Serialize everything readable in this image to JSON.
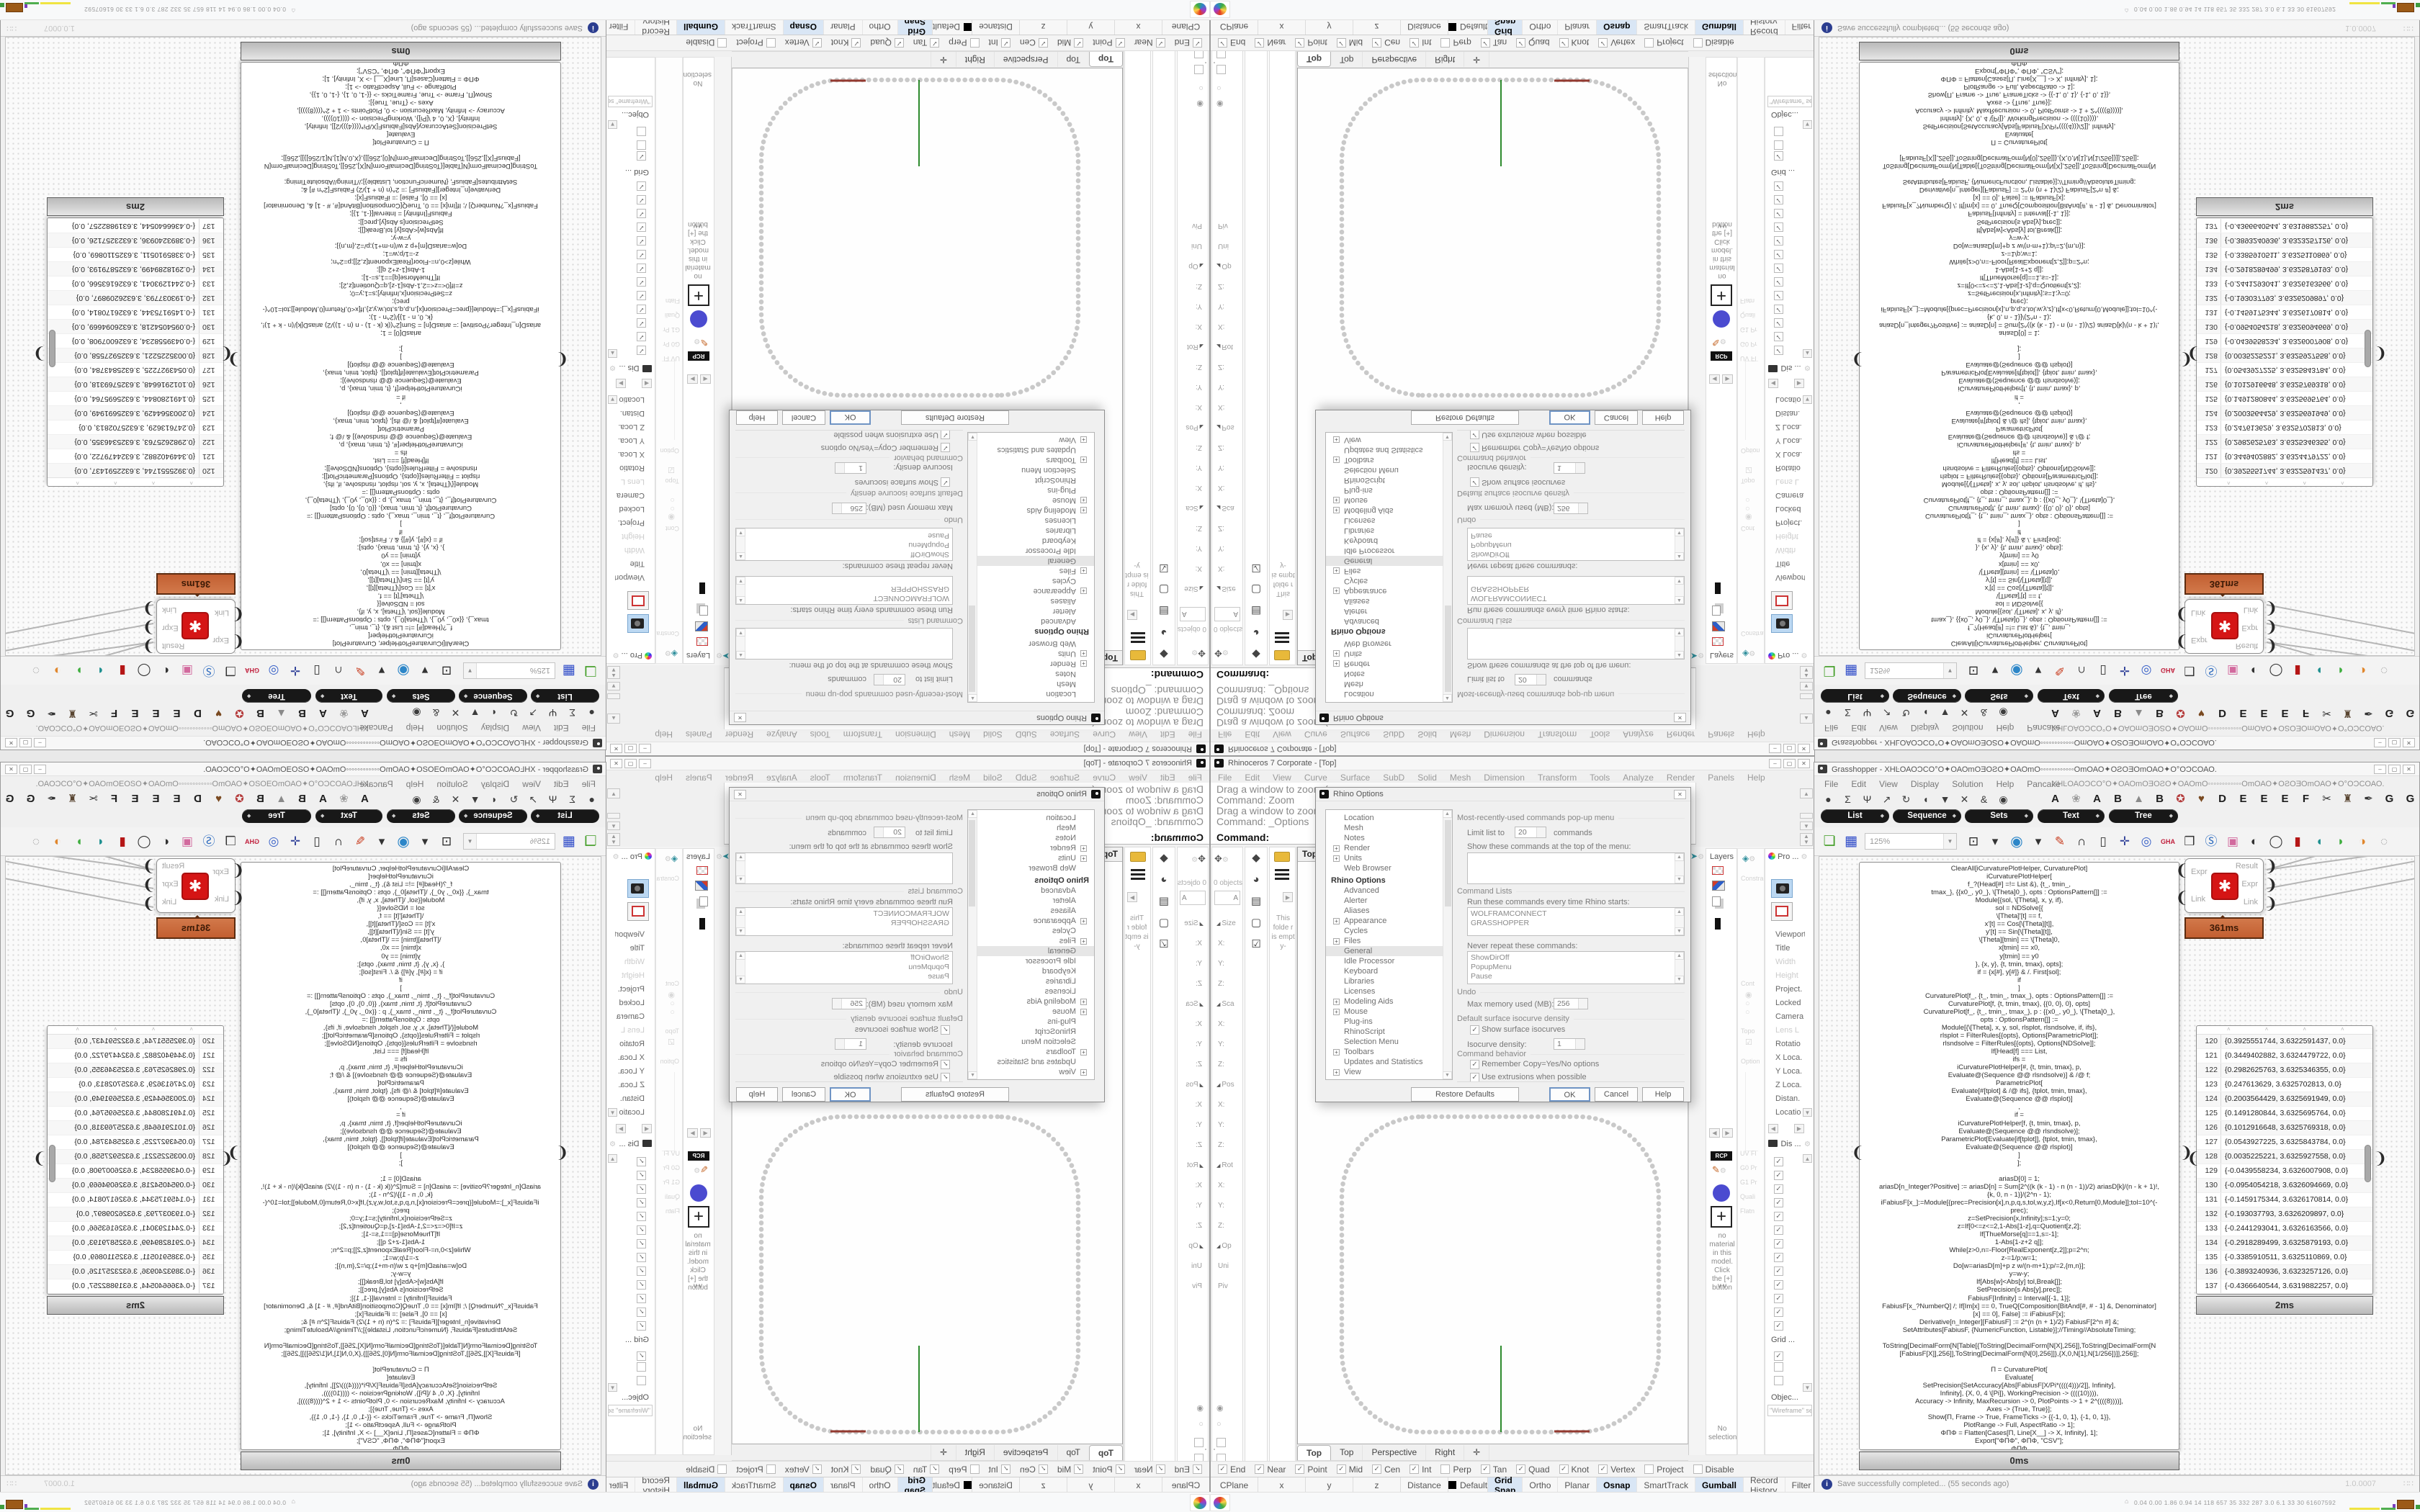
{
  "rhino": {
    "title": "Rhinoceros 7 Corporate - [Top]",
    "menus": [
      "File",
      "Edit",
      "View",
      "Curve",
      "Surface",
      "SubD",
      "Solid",
      "Mesh",
      "Dimension",
      "Transform",
      "Tools",
      "Analyze",
      "Render",
      "Panels",
      "Help"
    ],
    "window_buttons": [
      {
        "n": "minimize-button",
        "g": "–"
      },
      {
        "n": "maximize-button",
        "g": "▢"
      },
      {
        "n": "close-button",
        "g": "✕"
      }
    ],
    "command_history": [
      "Drag a window to zoom (",
      "Command: Zoom",
      "Drag a window to zoom (",
      "Command: _Options"
    ],
    "command_prompt": "Command:",
    "boxedit": {
      "objects_label": "0 objects",
      "field_value": "A",
      "rows": [
        {
          "t": "◢",
          "l": "Size"
        },
        {
          "t": "",
          "l": "X:"
        },
        {
          "t": "",
          "l": "Y:"
        },
        {
          "t": "",
          "l": "Z:"
        },
        {
          "t": "◢",
          "l": "Sca"
        },
        {
          "t": "",
          "l": "X:"
        },
        {
          "t": "",
          "l": "Y:"
        },
        {
          "t": "",
          "l": "Z:"
        },
        {
          "t": "◢",
          "l": "Pos"
        },
        {
          "t": "",
          "l": "X:"
        },
        {
          "t": "",
          "l": "Y:"
        },
        {
          "t": "",
          "l": "Z:"
        },
        {
          "t": "◢",
          "l": "Rot"
        },
        {
          "t": "",
          "l": "X:"
        },
        {
          "t": "",
          "l": "Y:"
        },
        {
          "t": "",
          "l": "Z:"
        },
        {
          "t": "◢",
          "l": "Op"
        },
        {
          "t": "",
          "l": "Uni"
        },
        {
          "t": "",
          "l": "Piv"
        }
      ]
    },
    "left_tabs": [
      {
        "n": "cap-icon",
        "g": "◆",
        "c": "#1a1a1a"
      },
      {
        "n": "sphere-icon",
        "g": "◕",
        "c": "#2f9c8e"
      },
      {
        "n": "panel2-icon",
        "g": "▤",
        "c": "#5a3aa8"
      },
      {
        "n": "swatch-icon",
        "g": "▢",
        "c": "#bbb"
      },
      {
        "n": "checkpen-icon",
        "g": "☑",
        "c": "#8a8a8a"
      }
    ],
    "folder_note": "This folde r is empt y-",
    "viewport": {
      "label": "Top",
      "tabs": [
        {
          "l": "Top",
          "on": "1"
        },
        {
          "l": "Top",
          "on": ""
        },
        {
          "l": "Perspective",
          "on": ""
        },
        {
          "l": "Right",
          "on": ""
        },
        {
          "l": "✛",
          "on": ""
        }
      ]
    },
    "osnap": [
      {
        "l": "End",
        "c": "✓"
      },
      {
        "l": "Near",
        "c": "✓"
      },
      {
        "l": "Point",
        "c": "✓"
      },
      {
        "l": "Mid",
        "c": "✓"
      },
      {
        "l": "Cen",
        "c": "✓"
      },
      {
        "l": "Int",
        "c": "✓"
      },
      {
        "l": "Perp",
        "c": ""
      },
      {
        "l": "Tan",
        "c": "✓"
      },
      {
        "l": "Quad",
        "c": "✓"
      },
      {
        "l": "Knot",
        "c": "✓"
      },
      {
        "l": "Vertex",
        "c": "✓"
      },
      {
        "l": "Project",
        "c": ""
      },
      {
        "l": "Disable",
        "c": ""
      }
    ],
    "status": {
      "cells": [
        "CPlane",
        "x",
        "y",
        "z",
        "Distance"
      ],
      "default_label": "Default",
      "toggles": [
        {
          "l": "Grid Snap",
          "on": "1"
        },
        {
          "l": "Ortho",
          "on": ""
        },
        {
          "l": "Planar",
          "on": ""
        },
        {
          "l": "Osnap",
          "on": "1"
        },
        {
          "l": "SmartTrack",
          "on": ""
        },
        {
          "l": "Gumball",
          "on": "1"
        },
        {
          "l": "Record History",
          "on": ""
        },
        {
          "l": "Filter",
          "on": ""
        }
      ]
    },
    "layers_title": "Layers",
    "materials": {
      "rcp": "RCP",
      "empty_text": "no material in this model. Click the [+] button",
      "chevrons": "∨∨",
      "no_selection": "No selection"
    },
    "constraints": {
      "title": "Constra",
      "faint1": "Cont",
      "faint2": "Topo",
      "faint3": "Option",
      "labels": [
        "UV Fl",
        "G0 Pr",
        "G1 Pr",
        "Quali",
        "Flatn"
      ]
    },
    "properties": {
      "title": "Pro ...",
      "rows": [
        {
          "l": "Viewport",
          "d": "",
          "s": ""
        },
        {
          "l": "Title",
          "d": "",
          "s": ""
        },
        {
          "l": "Width",
          "d": "1",
          "s": ""
        },
        {
          "l": "Height",
          "d": "1",
          "s": ""
        },
        {
          "l": "Project.",
          "d": "",
          "s": ""
        },
        {
          "l": "Locked",
          "d": "",
          "s": ""
        },
        {
          "l": "Camera",
          "d": "",
          "s": "1"
        },
        {
          "l": "Lens L",
          "d": "1",
          "s": ""
        },
        {
          "l": "Rotatio",
          "d": "",
          "s": ""
        },
        {
          "l": "X Loca.",
          "d": "",
          "s": ""
        },
        {
          "l": "Y Loca.",
          "d": "",
          "s": ""
        },
        {
          "l": "Z Loca.",
          "d": "",
          "s": ""
        },
        {
          "l": "Distan.",
          "d": "",
          "s": ""
        },
        {
          "l": "Locatio",
          "d": "",
          "s": ""
        }
      ],
      "display_title": "Dis ...",
      "display_checks": [
        "✓",
        "✓",
        "✓",
        "✓",
        "✓",
        "✓",
        "✓",
        "✓",
        "✓",
        "✓",
        "✓",
        "✓",
        "✓"
      ],
      "grid_label": "Grid ...",
      "grid_checks": [
        "✓",
        "",
        ""
      ],
      "object_label": "Objec...",
      "object_field": "\"Wireframe\" set"
    },
    "options_dialog": {
      "title": "Rhino Options",
      "tree": [
        {
          "p": "",
          "k": "",
          "l": "Location"
        },
        {
          "p": "",
          "k": "",
          "l": "Mesh"
        },
        {
          "p": "",
          "k": "",
          "l": "Notes"
        },
        {
          "p": "+",
          "k": "",
          "l": "Render"
        },
        {
          "p": "+",
          "k": "",
          "l": "Units"
        },
        {
          "p": "",
          "k": "",
          "l": "Web Browser"
        },
        {
          "p": "",
          "k": "h",
          "l": "Rhino Options"
        },
        {
          "p": "",
          "k": "",
          "l": "Advanced"
        },
        {
          "p": "",
          "k": "",
          "l": "Alerter"
        },
        {
          "p": "",
          "k": "",
          "l": "Aliases"
        },
        {
          "p": "+",
          "k": "",
          "l": "Appearance"
        },
        {
          "p": "",
          "k": "",
          "l": "Cycles"
        },
        {
          "p": "+",
          "k": "",
          "l": "Files"
        },
        {
          "p": "",
          "k": "sel",
          "l": "General"
        },
        {
          "p": "",
          "k": "",
          "l": "Idle Processor"
        },
        {
          "p": "",
          "k": "",
          "l": "Keyboard"
        },
        {
          "p": "",
          "k": "",
          "l": "Libraries"
        },
        {
          "p": "",
          "k": "",
          "l": "Licenses"
        },
        {
          "p": "+",
          "k": "",
          "l": "Modeling Aids"
        },
        {
          "p": "+",
          "k": "",
          "l": "Mouse"
        },
        {
          "p": "",
          "k": "",
          "l": "Plug-ins"
        },
        {
          "p": "",
          "k": "",
          "l": "RhinoScript"
        },
        {
          "p": "",
          "k": "",
          "l": "Selection Menu"
        },
        {
          "p": "+",
          "k": "",
          "l": "Toolbars"
        },
        {
          "p": "",
          "k": "",
          "l": "Updates and Statistics"
        },
        {
          "p": "+",
          "k": "",
          "l": "View"
        }
      ],
      "group1_label": "Most-recently-used commands pop-up menu",
      "limit_prefix": "Limit list to",
      "limit_value": "20",
      "limit_suffix": "commands",
      "show_label": "Show these commands at the top of the menu:",
      "group2_label": "Command Lists",
      "run_label": "Run these commands every time Rhino starts:",
      "run_items": [
        "WOLFRAMCONNECT",
        "GRASSHOPPER"
      ],
      "never_label": "Never repeat these commands:",
      "never_items": [
        "ShowDirOff",
        "PopupMenu",
        "Pause"
      ],
      "undo_label": "Undo",
      "memory_label": "Max memory used (MB):",
      "memory_value": "256",
      "iso_label": "Default surface isocurve density",
      "iso_show": "Show surface isocurves",
      "iso_density_label": "Isocurve density:",
      "iso_density_value": "1",
      "behavior_label": "Command behavior",
      "behavior_cb1": "Remember Copy=Yes/No options",
      "behavior_cb2": "Use extrusions when possible",
      "buttons": [
        {
          "n": "restore-defaults-button",
          "l": "Restore Defaults"
        },
        {
          "n": "ok-button",
          "l": "OK"
        },
        {
          "n": "cancel-button",
          "l": "Cancel"
        },
        {
          "n": "help-button",
          "l": "Help"
        }
      ]
    }
  },
  "grasshopper": {
    "title": "Grasshopper - XHĿΟΑΟƆCΟ°Ο✦ΟΑΟmΟƎΟƧΟ✦ΟΑΟmΟ◦◦◦◦◦◦◦◦◦◦◦◦ΟmΟΑΟ✦ΟƧΟƎΟmΟΑΟ✦Ο°ΟƆCΟΑΟ.",
    "menus": [
      "File",
      "Edit",
      "View",
      "Display",
      "Solution",
      "Help",
      "Pancake"
    ],
    "doc_garble": "XHĿΟΑΟƆCΟ°Ο✦ΟΑΟmΟƎΟƧΟ✦ΟΑΟmΟ◦◦◦◦◦◦◦◦◦◦◦◦ΟmΟΑΟ✦ΟƧΟƎΟmΟΑΟ✦Ο°ΟƆCΟΑΟ.",
    "window_buttons": [
      {
        "n": "minimize-button",
        "g": "–"
      },
      {
        "n": "maximize-button",
        "g": "▢"
      },
      {
        "n": "close-button",
        "g": "✕"
      }
    ],
    "main_tabs": [
      {
        "n": "tab-params",
        "g": "●",
        "sel": ""
      },
      {
        "n": "tab-maths",
        "g": "Σ",
        "sel": ""
      },
      {
        "n": "tab-sets",
        "g": "Ψ",
        "sel": "1"
      },
      {
        "n": "tab-vector",
        "g": "↗",
        "sel": ""
      },
      {
        "n": "tab-curve",
        "g": "↻",
        "sel": ""
      },
      {
        "n": "tab-surface",
        "g": "◖",
        "sel": ""
      },
      {
        "n": "tab-mesh",
        "g": "▼",
        "sel": ""
      },
      {
        "n": "tab-intersect",
        "g": "✕",
        "sel": ""
      },
      {
        "n": "tab-transform",
        "g": "&",
        "sel": ""
      },
      {
        "n": "tab-display",
        "g": "◉",
        "sel": ""
      }
    ],
    "letter_tabs": [
      "A",
      "❀",
      "A",
      "B",
      "▲",
      "B",
      "✪",
      "♥",
      "D",
      "E",
      "E",
      "E",
      "F",
      "✂",
      "♜",
      "✒",
      "G",
      "G"
    ],
    "pills": [
      "List",
      "Sequence",
      "Sets",
      "Text",
      "Tree"
    ],
    "zoom_level": "125%",
    "toolbar_group1": [
      {
        "n": "open-file-icon",
        "g": "❏"
      },
      {
        "n": "save-file-icon",
        "g": "▦"
      }
    ],
    "toolbar_group2": [
      {
        "n": "zoom-extents-icon",
        "g": "⊡"
      },
      {
        "n": "zoom-caret-icon",
        "g": "▾"
      },
      {
        "n": "preview-eye-icon",
        "g": "◉"
      },
      {
        "n": "preview-caret-icon",
        "g": "▾"
      },
      {
        "n": "sketch-brush-icon",
        "g": "✎"
      },
      {
        "n": "headphones-icon",
        "g": "∩"
      },
      {
        "n": "speaker-icon",
        "g": "▯"
      },
      {
        "n": "axes-icon",
        "g": "✛"
      },
      {
        "n": "connect-icon",
        "g": "◎"
      },
      {
        "n": "gha-badge-icon",
        "g": "GHA"
      },
      {
        "n": "window-chart-icon",
        "g": "❒"
      },
      {
        "n": "script-search-icon",
        "g": "Ⓢ"
      },
      {
        "n": "package-icon",
        "g": "▣"
      },
      {
        "n": "sphere-bw-icon",
        "g": "◐"
      },
      {
        "n": "cylinder-icon",
        "g": "◯"
      },
      {
        "n": "red-cylinder-icon",
        "g": "▮"
      },
      {
        "n": "teal-blob-icon",
        "g": "◖"
      },
      {
        "n": "green-blob-icon",
        "g": "◗"
      },
      {
        "n": "orange-sphere-icon",
        "g": "◑"
      },
      {
        "n": "selection-circle-icon",
        "g": "◌"
      }
    ],
    "code_time": "0ms",
    "code_lines": [
      "ClearAll[iCurvaturePlotHelper, CurvaturePlot]",
      "iCurvaturePlotHelper[",
      "f_?(Head[#] =!= List &), {t_, tmin_,",
      "tmax_}, {{x0_, y0_}, \\[Theta]0_}, opts : OptionsPattern[]] :=",
      "Module[{sol, \\[Theta], x, y, if},",
      "sol = NDSolve[{",
      "\\[Theta]'[t] == f,",
      "x'[t] == Cos[\\[Theta][t]],",
      "y'[t] == Sin[\\[Theta][t]],",
      "\\[Theta][tmin] == \\[Theta]0,",
      "x[tmin] == x0,",
      "y[tmin] == y0",
      "}, {x, y}, {t, tmin, tmax}, opts];",
      "if = {x[#], y[#]} & /. First[sol];",
      "if",
      "]",
      "CurvaturePlot[f_, {t_, tmin_, tmax_}, opts : OptionsPattern[]] :=",
      "CurvaturePlot[f, {t, tmin, tmax}, {{0, 0}, 0}, opts]",
      "CurvaturePlot[f_, {t_, tmin_, tmax_}, p : {{x0_, y0_}, \\[Theta]0_},",
      "opts : OptionsPattern[]] :=",
      "Module[{\\[Theta], x, y, sol, rlsplot, rlsndsolve, if, ifs},",
      "rlsplot = FilterRules[{opts}, Options[ParametricPlot]];",
      "rlsndsolve = FilterRules[{opts}, Options[NDSolve]];",
      "If[Head[f] === List,",
      "ifs =",
      "iCurvaturePlotHelper[#, {t, tmin, tmax}, p,",
      "Evaluate@(Sequence @@ rlsndsolve)] & /@ f;",
      "ParametricPlot[",
      "Evaluate[#[tplot] & /@ ifs], {tplot, tmin, tmax},",
      "Evaluate@(Sequence @@ rlsplot)]",
      ",",
      "if =",
      "iCurvaturePlotHelper[f, {t, tmin, tmax}, p,",
      "Evaluate@(Sequence @@ rlsndsolve)];",
      "ParametricPlot[Evaluate[if[tplot]], {tplot, tmin, tmax},",
      "Evaluate@(Sequence @@ rlsplot)]",
      "]",
      "];",
      "",
      "ariasD[0] = 1;",
      "ariasD[n_Integer?Positive] := ariasD[n] = Sum[2^((k (k - 1) - n (n - 1))/2) ariasD[k]/(n - k + 1)!,",
      "{k, 0, n - 1}]/(2^n - 1);",
      "iFabiusF[x_]:=Module[{prec=Precision[x],n,p,q,s,tol,w,y,z},If[x<0,Return[0,Module]];tol=10^(-",
      "prec);",
      "z=SetPrecision[x,Infinity];s=1;y=0;",
      "z=If[0<=z<=2,1-Abs[1-z],q=Quotient[z,2];",
      "If[ThueMorse[q]==1,s=-1];",
      "1-Abs[1-z+2 q]];",
      "While[z>0,n=-Floor[RealExponent[z,2]];p=2^n;",
      "z-=1/p;w=1;",
      "Do[w=ariasD[m]+p z w/(n-m+1);p/=2,{m,n}];",
      "y=w-y;",
      "If[Abs[w]<Abs[y] tol,Break[]];",
      "SetPrecision[s Abs[y],prec]];",
      "FabiusF[Infinity] = Interval[{-1, 1}];",
      "FabiusF[x_?NumberQ] /; If[Im[x] == 0, TrueQ[Composition[BitAnd[#, # - 1] &, Denominator]",
      "[x] == 0], False] := iFabiusF[x];",
      "Derivative[n_Integer][FabiusF] := 2^(n (n + 1)/2) FabiusF[2^n #] &;",
      "SetAttributes[FabiusF, {NumericFunction, Listable}];//Timing//AbsoluteTiming;",
      "",
      "ToString[DecimalForm[N[Table[{ToString[DecimalForm[N[X],256]],ToString[DecimalForm[N",
      "[FabiusF[X]],256]],ToString[DecimalForm[N[0],256]]},{X,0,N[1],N[1/256]}]],256]];",
      "",
      "Π = CurvaturePlot[",
      "Evaluate[",
      "SetPrecision[SetAccuracy[Abs[FabiusF[X/Pi*((((4)))/2]], Infinity],",
      "Infinity], {X, 0, 4 \\[Pi]}, WorkingPrecision -> ((((10)))),",
      "Accuracy -> Infinity, MaxRecursion -> 0, PlotPoints -> 1 + 2^((((8))))],",
      "Axes -> {True, True}];",
      "Show[Π, Frame -> True, FrameTicks -> {{-1, 0, 1}, {-1, 0, 1}},",
      "PlotRange -> Full, AspectRatio -> 1];",
      "ΦΠΦ = Flatten[Cases[Π, Line[X__] -> X, Infinity], 1];",
      "Export[\"ΦΠΦ\", ΦΠΦ, \"CSV\"];",
      "ΦΠΦ"
    ],
    "wolfram": {
      "inputs": [
        "Expr",
        "Link"
      ],
      "outputs": [
        "Result",
        "Expr",
        "Link"
      ],
      "time": "361ms"
    },
    "list_time": "2ms",
    "list_rows": [
      {
        "n": "120",
        "v": "{0.3925551744, 3.6322591437, 0.0}"
      },
      {
        "n": "121",
        "v": "{0.3449402882, 3.6324479722, 0.0}"
      },
      {
        "n": "122",
        "v": "{0.2982625763, 3.6325346355, 0.0}"
      },
      {
        "n": "123",
        "v": "{0.247613629, 3.6325702813, 0.0}"
      },
      {
        "n": "124",
        "v": "{0.2003564429, 3.6325691949, 0.0}"
      },
      {
        "n": "125",
        "v": "{0.1491280844, 3.6325695764, 0.0}"
      },
      {
        "n": "126",
        "v": "{0.1012916648, 3.6325769318, 0.0}"
      },
      {
        "n": "127",
        "v": "{0.0543927225, 3.6325843784, 0.0}"
      },
      {
        "n": "128",
        "v": "{0.0035225221, 3.6325927558, 0.0}"
      },
      {
        "n": "129",
        "v": "{-0.0439558234, 3.6326007908, 0.0}"
      },
      {
        "n": "130",
        "v": "{-0.0954054218, 3.6326094669, 0.0}"
      },
      {
        "n": "131",
        "v": "{-0.1459175344, 3.6326170814, 0.0}"
      },
      {
        "n": "132",
        "v": "{-0.193037793, 3.6326209897, 0.0}"
      },
      {
        "n": "133",
        "v": "{-0.2441293041, 3.6326163566, 0.0}"
      },
      {
        "n": "134",
        "v": "{-0.2918289499, 3.6325879193, 0.0}"
      },
      {
        "n": "135",
        "v": "{-0.3385910511, 3.6325110869, 0.0}"
      },
      {
        "n": "136",
        "v": "{-0.3893240936, 3.6323257126, 0.0}"
      },
      {
        "n": "137",
        "v": "{-0.4366640544, 3.6319882257, 0.0}"
      }
    ],
    "status_message": "Save successfully completed... (55 seconds ago)",
    "version": "1.0.0007"
  },
  "taskbar": {
    "icons": [
      "app-green-icon",
      "firefox-icon",
      "save64-icon",
      "rhino-icon",
      "wolfram-icon",
      "gear-icon",
      "notepad-icon",
      "gimp-icon",
      "palette-icon"
    ],
    "stats": "0.04 0.00 1.86 0.94   14   118  657   35   332  287   3.0   6.1   33   30  61607592"
  }
}
